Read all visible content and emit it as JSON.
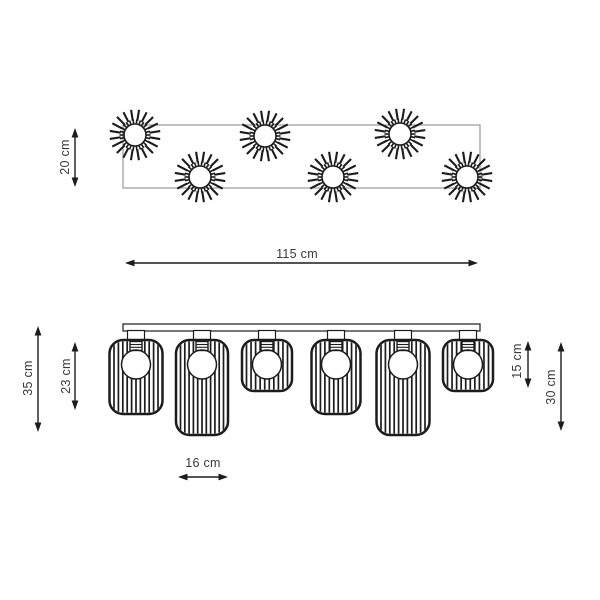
{
  "colors": {
    "ink": "#1c1c1c",
    "frame_gray": "#9a9a9a",
    "text": "#3a3a3a",
    "background": "#ffffff"
  },
  "labels": {
    "top_depth": "20 cm",
    "top_width": "115 cm",
    "overall_height": "35 cm",
    "medium_shade_height": "23 cm",
    "small_shade_height": "15 cm",
    "tall_shade_height": "30 cm",
    "shade_width": "16 cm"
  },
  "top_view": {
    "frame": {
      "x": 123,
      "y": 125,
      "w": 357,
      "h": 63
    },
    "sunbursts": [
      {
        "x": 135,
        "y": 135
      },
      {
        "x": 265,
        "y": 136
      },
      {
        "x": 400,
        "y": 134
      },
      {
        "x": 200,
        "y": 177
      },
      {
        "x": 333,
        "y": 177
      },
      {
        "x": 467,
        "y": 177
      }
    ],
    "sunburst_style": {
      "core_r": 11,
      "tick_r1": 10.8,
      "tick_r2": 15.5,
      "tick_count": 26,
      "spoke_r1": 14.5,
      "spoke_r2": 25.5,
      "spoke_count": 20
    }
  },
  "front_view": {
    "bar": {
      "x": 123,
      "y": 324,
      "w": 357,
      "h": 7
    },
    "stem": {
      "w": 17,
      "h": 10
    },
    "bulb": {
      "r": 14.5,
      "socket_w": 12,
      "socket_h": 9
    },
    "shades": [
      {
        "cx": 136,
        "w": 53,
        "top": 340,
        "bottom": 414,
        "size": "medium"
      },
      {
        "cx": 202,
        "w": 52,
        "top": 340,
        "bottom": 435,
        "size": "tall"
      },
      {
        "cx": 267,
        "w": 50,
        "top": 340,
        "bottom": 391,
        "size": "small"
      },
      {
        "cx": 336,
        "w": 49,
        "top": 340,
        "bottom": 414,
        "size": "medium"
      },
      {
        "cx": 403,
        "w": 53,
        "top": 340,
        "bottom": 435,
        "size": "tall"
      },
      {
        "cx": 468,
        "w": 50,
        "top": 340,
        "bottom": 391,
        "size": "small"
      }
    ]
  },
  "dimensions": [
    {
      "id": "top-depth",
      "label_key": "top_depth",
      "orient": "v",
      "x": 75,
      "y1": 128,
      "y2": 187
    },
    {
      "id": "top-width",
      "label_key": "top_width",
      "orient": "h",
      "y": 263,
      "x1": 125,
      "x2": 478
    },
    {
      "id": "overall-height",
      "label_key": "overall_height",
      "orient": "v",
      "x": 38,
      "y1": 326,
      "y2": 432
    },
    {
      "id": "medium-shade-height",
      "label_key": "medium_shade_height",
      "orient": "v",
      "x": 75,
      "y1": 342,
      "y2": 410
    },
    {
      "id": "small-shade-height",
      "label_key": "small_shade_height",
      "orient": "v",
      "x": 528,
      "y1": 341,
      "y2": 388
    },
    {
      "id": "tall-shade-height",
      "label_key": "tall_shade_height",
      "orient": "v",
      "x": 561,
      "y1": 342,
      "y2": 431
    },
    {
      "id": "shade-width",
      "label_key": "shade_width",
      "orient": "h",
      "y": 477,
      "x1": 178,
      "x2": 228
    }
  ]
}
